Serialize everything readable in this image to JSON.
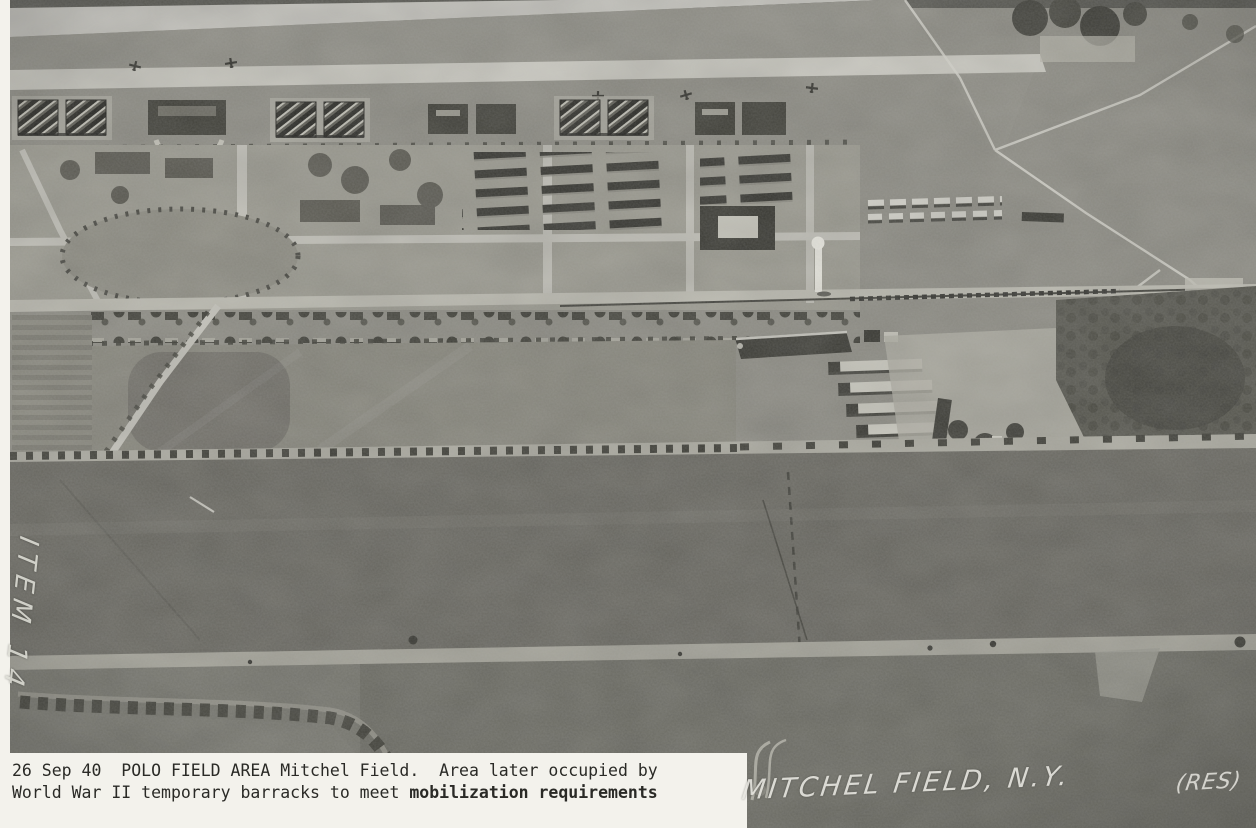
{
  "photo": {
    "margin_note": "ITEM 14",
    "stamp": "MITCHEL FIELD, N.Y.",
    "res_mark": "(RES)",
    "caption": {
      "line1": "26 Sep 40  POLO FIELD AREA Mitchel Field.  Area later occupied by",
      "line2_regular": "World War II temporary barracks to meet ",
      "line2_bold": "mobilization requirements"
    },
    "colors": {
      "paper": "#f3f2ec",
      "ink": "#2a2a26",
      "stamp_white": "#e6e5df",
      "runway": "#c7c6c0",
      "taxiway": "#cbcac2",
      "grass": "#8f8e86",
      "campus": "#9b9a90",
      "polo_field": "#87867c",
      "field_dark": "#67665f",
      "scrub": "#54544c",
      "hangar_dark": "#2c2c27"
    }
  }
}
